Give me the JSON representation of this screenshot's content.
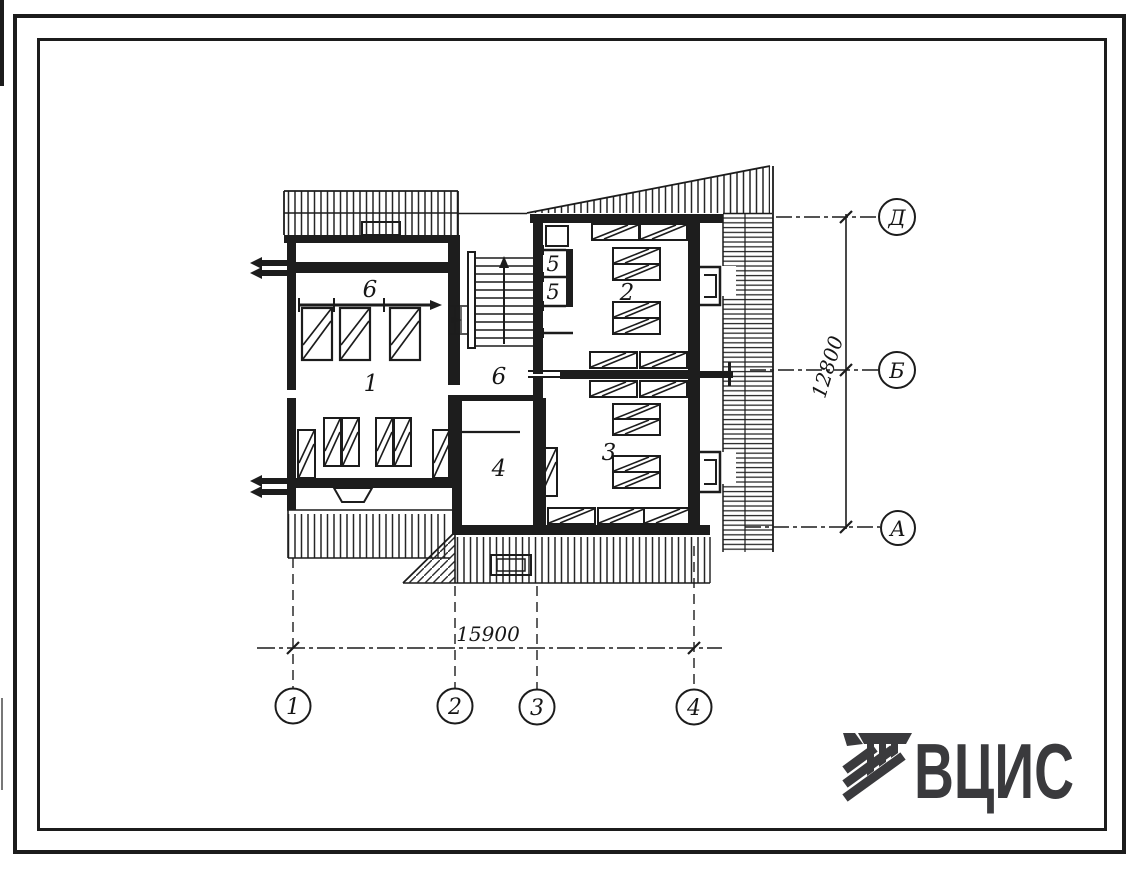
{
  "plan": {
    "rooms": [
      {
        "label": "6"
      },
      {
        "label": "1"
      },
      {
        "label": "5"
      },
      {
        "label": "5"
      },
      {
        "label": "6"
      },
      {
        "label": "2"
      },
      {
        "label": "3"
      },
      {
        "label": "4"
      }
    ]
  },
  "dimensions": {
    "horizontal": "15900",
    "vertical": "12800"
  },
  "axes": {
    "bottom": [
      {
        "label": "1"
      },
      {
        "label": "2"
      },
      {
        "label": "3"
      },
      {
        "label": "4"
      }
    ],
    "right": [
      {
        "label": "Д"
      },
      {
        "label": "Б"
      },
      {
        "label": "А"
      }
    ]
  },
  "logo": {
    "wordmark": "ВЦИС"
  },
  "colors": {
    "ink": "#1c1c1c",
    "logo_ink": "#3a3a3d",
    "paper": "#ffffff"
  }
}
